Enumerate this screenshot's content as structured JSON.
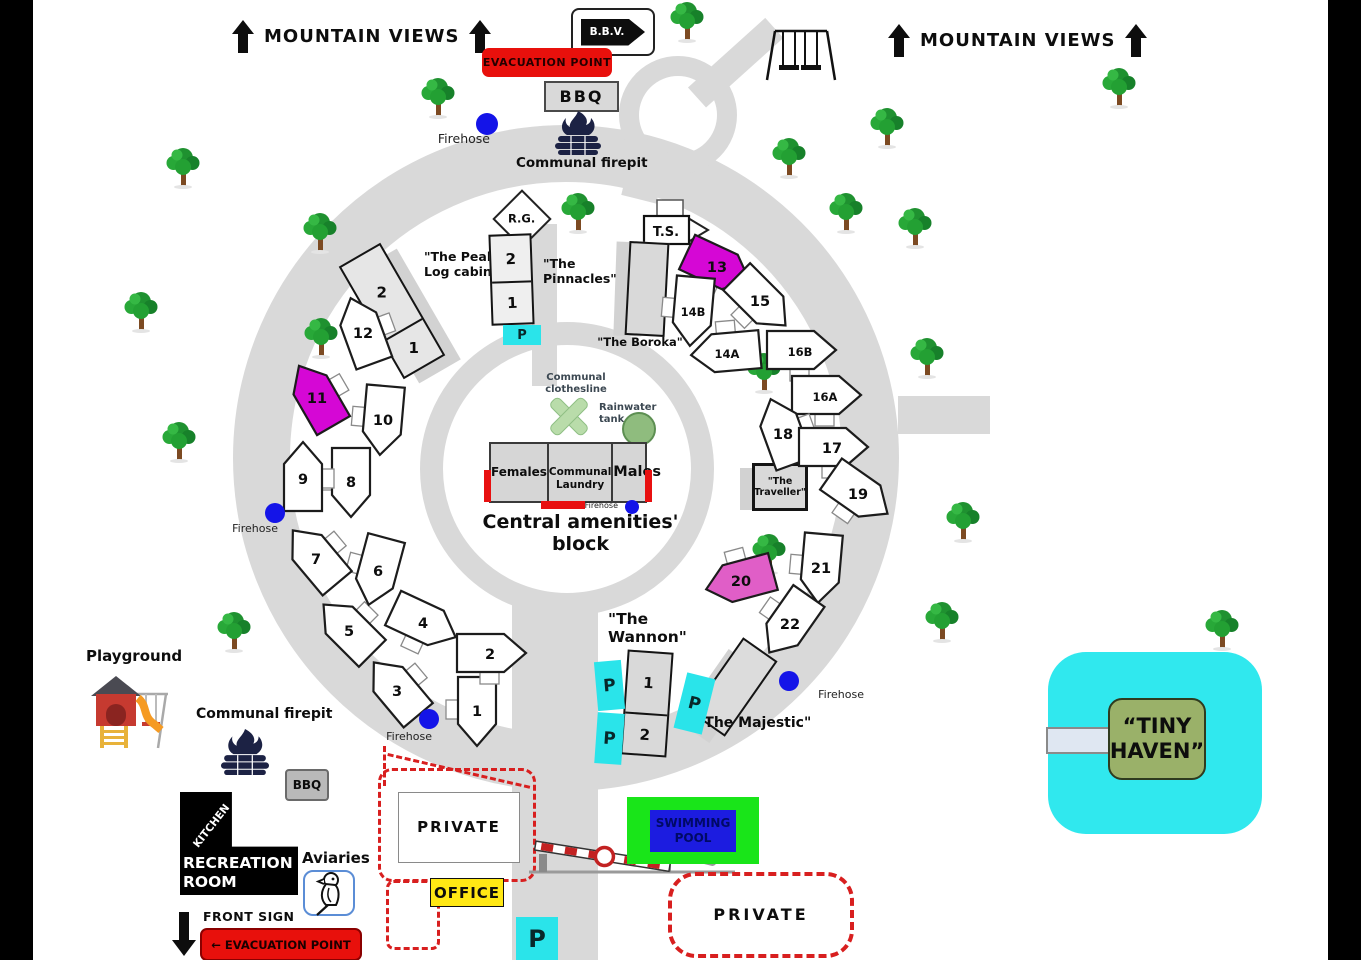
{
  "signs": {
    "mountain_views": "MOUNTAIN VIEWS",
    "bbv": "B.B.V.",
    "evacuation_point": "EVACUATION POINT",
    "bbq": "BBQ",
    "front_sign": "FRONT SIGN",
    "front_evacuation": "← EVACUATION POINT",
    "office": "OFFICE",
    "private_upper": "PRIVATE",
    "private_lower": "PRIVATE",
    "swimming_pool": "SWIMMING\nPOOL",
    "tiny_haven": "“TINY\nHAVEN”",
    "rg": "R.G.",
    "ts": "T.S.",
    "parking": "P"
  },
  "amenities": {
    "title": "Central amenities' block",
    "females": "Females",
    "laundry": "Communal\nLaundry",
    "males": "Males",
    "clothesline": "Communal\nclothesline",
    "rainwater": "Rainwater\ntank",
    "firehose": "Firehose"
  },
  "features": {
    "playground": "Playground",
    "communal_firepit": "Communal firepit",
    "aviaries": "Aviaries",
    "kitchen": "KITCHEN",
    "recreation_room": "RECREATION\nROOM",
    "bbq_lower": "BBQ"
  },
  "cabins": {
    "peaks": {
      "label": "\"The Peaks\"\nLog cabin",
      "sections": [
        "2",
        "1"
      ]
    },
    "pinnacles": {
      "label": "\"The\nPinnacles\"",
      "sections": [
        "2",
        "1"
      ]
    },
    "boroka": {
      "label": "\"The Boroka\""
    },
    "traveller": {
      "label": "\"The\nTraveller\""
    },
    "wannon": {
      "label": "\"The\nWannon\"",
      "sections": [
        "1",
        "2"
      ]
    },
    "majestic": {
      "label": "\"The Majestic\""
    }
  },
  "colors": {
    "road": "#d9d9d9",
    "site_magenta": "#d507d5",
    "site_pink": "#e05ec7",
    "parking_cyan": "#2ae4ea",
    "evac_red": "#e8100c",
    "pool_green": "#19e519",
    "pool_blue": "#1c1ce0",
    "office_yellow": "#ffe814",
    "haven_cyan": "#30e8ee",
    "haven_sign_green": "#9ab169",
    "tank_green": "#8fbc7e",
    "firehose_blue": "#1414e8"
  },
  "sites": [
    {
      "n": "1",
      "x": 477,
      "y": 710,
      "rot": 180
    },
    {
      "n": "2",
      "x": 490,
      "y": 653,
      "rot": 90
    },
    {
      "n": "3",
      "x": 397,
      "y": 690,
      "rot": -40
    },
    {
      "n": "4",
      "x": 423,
      "y": 622,
      "rot": 115
    },
    {
      "n": "5",
      "x": 349,
      "y": 630,
      "rot": -45
    },
    {
      "n": "6",
      "x": 378,
      "y": 570,
      "rot": 195
    },
    {
      "n": "7",
      "x": 316,
      "y": 558,
      "rot": -40
    },
    {
      "n": "8",
      "x": 351,
      "y": 481,
      "rot": 180
    },
    {
      "n": "9",
      "x": 303,
      "y": 478,
      "rot": 0
    },
    {
      "n": "10",
      "x": 383,
      "y": 419,
      "rot": 185
    },
    {
      "n": "11",
      "x": 317,
      "y": 397,
      "rot": -30,
      "c": "#d507d5"
    },
    {
      "n": "12",
      "x": 363,
      "y": 332,
      "rot": -20
    },
    {
      "n": "13",
      "x": 717,
      "y": 266,
      "rot": 115,
      "c": "#d507d5"
    },
    {
      "n": "14B",
      "x": 693,
      "y": 310,
      "rot": 185
    },
    {
      "n": "15",
      "x": 760,
      "y": 300,
      "rot": 135
    },
    {
      "n": "14A",
      "x": 727,
      "y": 352,
      "rot": -95
    },
    {
      "n": "16B",
      "x": 800,
      "y": 350,
      "rot": 90
    },
    {
      "n": "16A",
      "x": 825,
      "y": 395,
      "rot": 90
    },
    {
      "n": "18",
      "x": 783,
      "y": 433,
      "rot": -20
    },
    {
      "n": "17",
      "x": 832,
      "y": 447,
      "rot": 90
    },
    {
      "n": "19",
      "x": 858,
      "y": 493,
      "rot": 125
    },
    {
      "n": "20",
      "x": 741,
      "y": 580,
      "rot": -105,
      "c": "#e05ec7"
    },
    {
      "n": "21",
      "x": 821,
      "y": 567,
      "rot": 185
    },
    {
      "n": "22",
      "x": 790,
      "y": 623,
      "rot": 215
    }
  ],
  "trees": [
    [
      668,
      0
    ],
    [
      419,
      76
    ],
    [
      1100,
      66
    ],
    [
      868,
      106
    ],
    [
      164,
      146
    ],
    [
      770,
      136
    ],
    [
      827,
      191
    ],
    [
      559,
      191
    ],
    [
      301,
      211
    ],
    [
      896,
      206
    ],
    [
      122,
      290
    ],
    [
      302,
      316
    ],
    [
      908,
      336
    ],
    [
      745,
      351
    ],
    [
      160,
      420
    ],
    [
      944,
      500
    ],
    [
      750,
      532
    ],
    [
      215,
      610
    ],
    [
      923,
      600
    ],
    [
      1203,
      608
    ]
  ],
  "firehoses": [
    {
      "dot": [
        487,
        124,
        11
      ],
      "label": [
        420,
        131,
        12.5
      ]
    },
    {
      "dot": [
        275,
        513,
        10
      ],
      "label": [
        208,
        522,
        11
      ]
    },
    {
      "dot": [
        429,
        719,
        10
      ],
      "label": [
        362,
        730,
        11
      ]
    },
    {
      "dot": [
        632,
        507,
        7
      ],
      "label": [
        548,
        501,
        8
      ]
    },
    {
      "dot": [
        789,
        681,
        10
      ],
      "label": [
        794,
        688,
        11
      ]
    }
  ],
  "parkings": [
    {
      "x": 503,
      "y": 325,
      "w": 38,
      "h": 20,
      "fs": 13,
      "rot": 0
    },
    {
      "x": 596,
      "y": 661,
      "w": 27,
      "h": 49,
      "fs": 17,
      "rot": -5
    },
    {
      "x": 596,
      "y": 713,
      "w": 27,
      "h": 51,
      "fs": 17,
      "rot": 4
    },
    {
      "x": 680,
      "y": 675,
      "w": 29,
      "h": 57,
      "fs": 17,
      "rot": 14
    },
    {
      "x": 516,
      "y": 917,
      "w": 42,
      "h": 43,
      "fs": 24,
      "rot": 0
    }
  ]
}
